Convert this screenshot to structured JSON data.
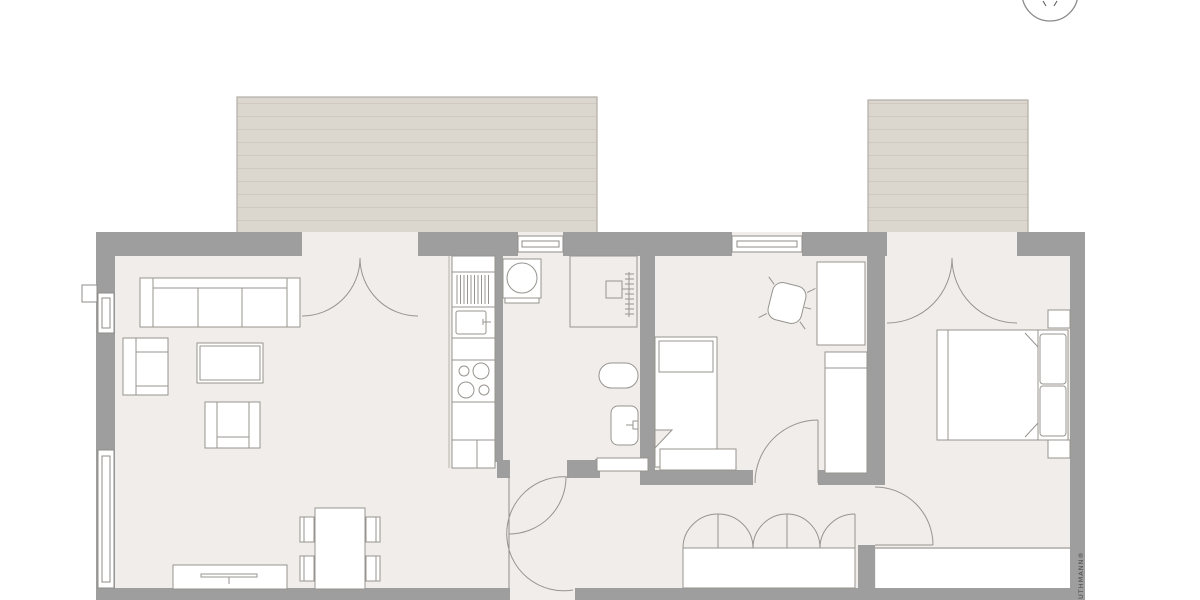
{
  "watermark": {
    "text": "UTHMANN®"
  },
  "compass": {
    "icon": "compass-icon"
  },
  "palette": {
    "background": "#ffffff",
    "floor": "#f1edea",
    "walls": "#9e9e9e",
    "terrace_fill": "#dbd6ce",
    "terrace_hatch": "#cfc9c1",
    "terrace_border": "#b2aea7",
    "outline": "#8f8d8a",
    "furniture_fill": "#ffffff"
  },
  "terraces": [
    {
      "name": "terrace-left"
    },
    {
      "name": "terrace-right"
    }
  ],
  "rooms": [
    {
      "name": "living-room",
      "furniture": [
        "sofa",
        "armchair",
        "armchair",
        "coffee-table",
        "tv-lowboard",
        "dining-table",
        "dining-chairs"
      ]
    },
    {
      "name": "kitchen",
      "furniture": [
        "tall-appliance",
        "sink",
        "cooktop",
        "base-cabinet"
      ]
    },
    {
      "name": "bathroom",
      "furniture": [
        "washing-machine",
        "shower",
        "toilet",
        "washbasin",
        "sliding-door"
      ]
    },
    {
      "name": "kids-room",
      "furniture": [
        "single-bed",
        "bed-drawer",
        "desk",
        "desk-chair",
        "wardrobe"
      ]
    },
    {
      "name": "hallway",
      "furniture": [
        "built-in-closet"
      ]
    },
    {
      "name": "bedroom",
      "furniture": [
        "double-bed",
        "nightstand",
        "nightstand"
      ]
    }
  ]
}
